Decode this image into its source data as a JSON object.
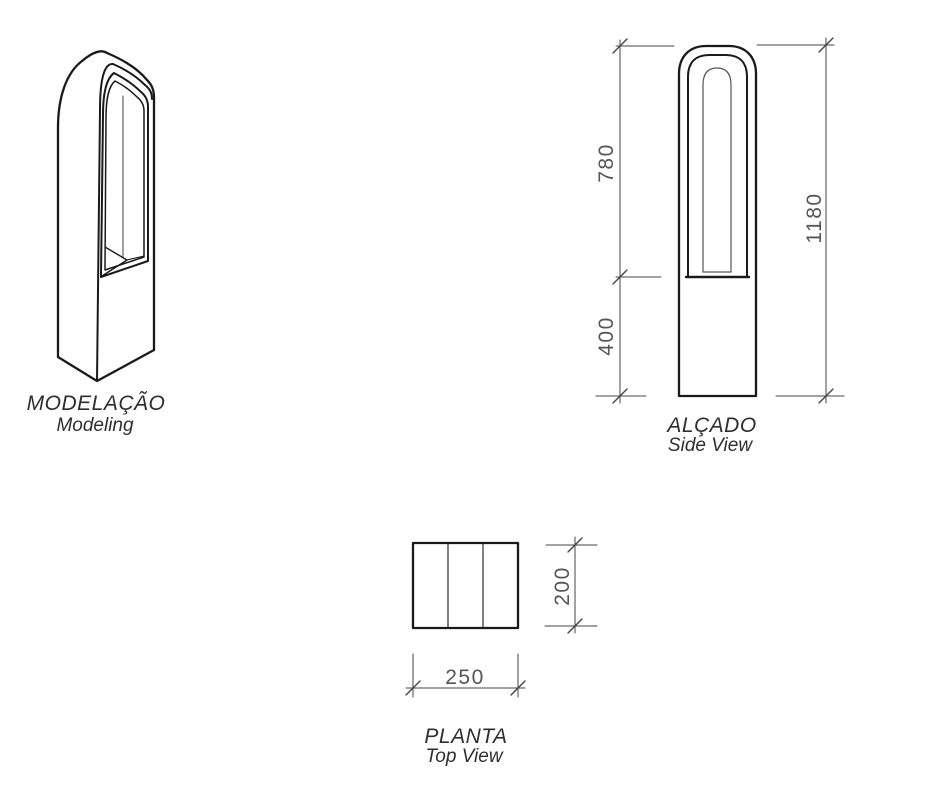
{
  "document": {
    "type": "technical-drawing",
    "background": "#ffffff"
  },
  "colors": {
    "line": "#1a1a1a",
    "thin_line": "#555555",
    "dimension_line": "#444444",
    "dimension_text": "#555555",
    "label_text": "#2e2e2e"
  },
  "views": {
    "modeling": {
      "title": "MODELAÇÃO",
      "subtitle": "Modeling"
    },
    "side_view": {
      "title": "ALÇADO",
      "subtitle": "Side View",
      "dimensions": {
        "upper_section": "780",
        "lower_section": "400",
        "total_height": "1180"
      }
    },
    "top_view": {
      "title": "PLANTA",
      "subtitle": "Top View",
      "dimensions": {
        "depth": "200",
        "width": "250"
      }
    }
  }
}
